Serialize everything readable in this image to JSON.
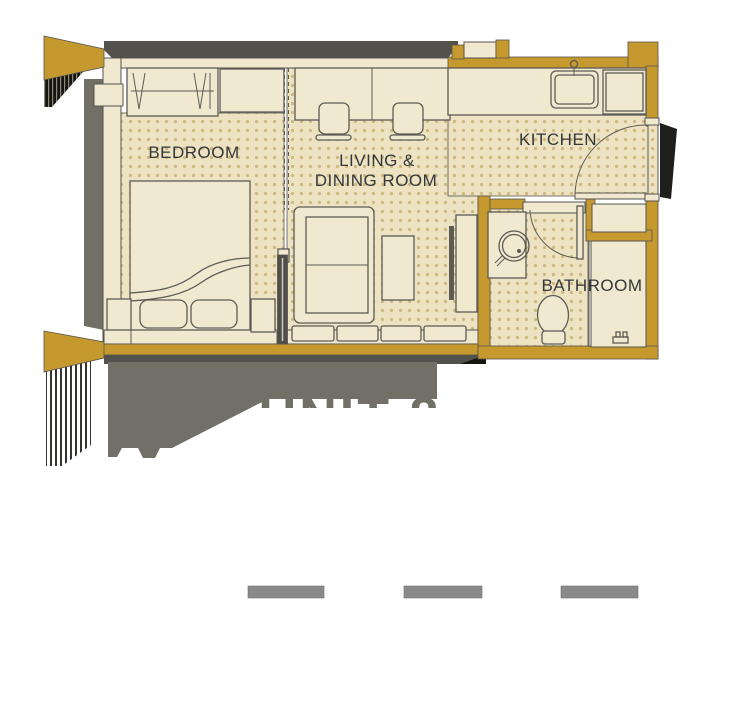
{
  "floor_plan": {
    "rooms": {
      "bedroom": {
        "label": "BEDROOM"
      },
      "living_dining": {
        "label_line1": "LIVING &",
        "label_line2": "DINING ROOM"
      },
      "kitchen": {
        "label": "KITCHEN"
      },
      "bathroom": {
        "label": "BATHROOM"
      }
    },
    "cropped_caption": {
      "text": "UNIT 8"
    },
    "colors": {
      "wall_gold": "#C6992F",
      "room_cream": "#F0E9D0",
      "floor_beige": "#EDE3C2",
      "floor_dot": "#CDB87E",
      "outline_dark": "#55544E",
      "furniture_line": "#5C5B55",
      "shadow_dark": "#52514C",
      "shadow_light": "#716F66",
      "dash_gray": "#8A8A8A",
      "label_text": "#33363A",
      "slide_door": "#4F4E49",
      "black_ink": "#15140F"
    }
  }
}
